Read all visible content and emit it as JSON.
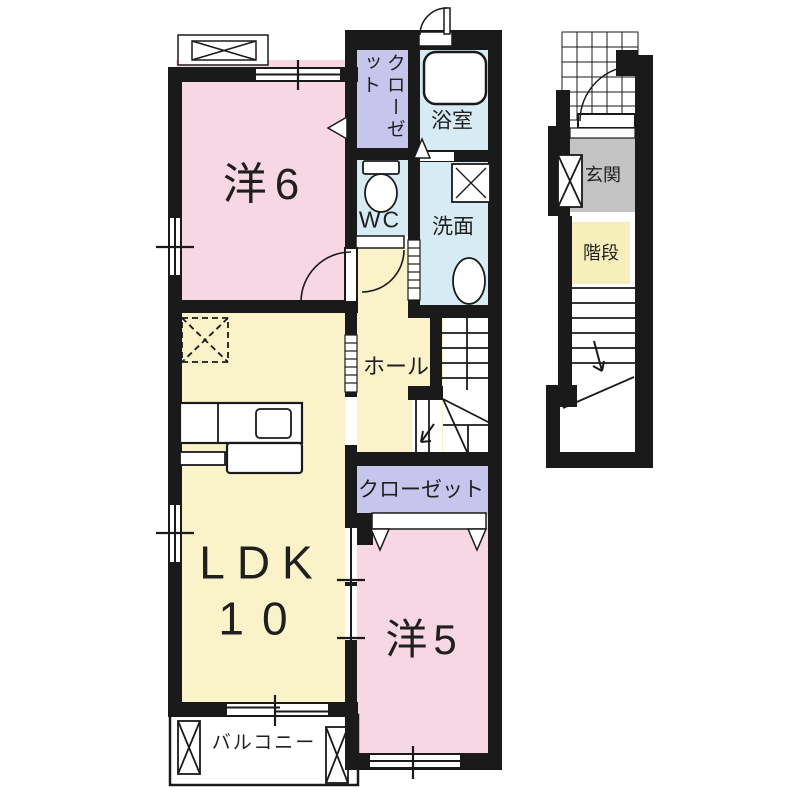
{
  "document_type": "apartment floor plan (2F unit with 1F entrance/stair section)",
  "colors": {
    "wall": "#1A1A1A",
    "room_pink": "#F8D7E4",
    "room_yellow": "#FAF3C9",
    "water_blue": "#D6EBF4",
    "closet_purple": "#C7C5EC",
    "entrance_gray": "#C3C3C3",
    "stairs_label_yellow": "#F6EFBC",
    "white": "#FFFFFF"
  },
  "rooms": {
    "western_room_6": {
      "label": "洋6"
    },
    "closet_upper": {
      "label": "クローゼット"
    },
    "bathroom": {
      "label": "浴室"
    },
    "toilet": {
      "label": "WC"
    },
    "washroom": {
      "label": "洗面"
    },
    "hall": {
      "label": "ホール"
    },
    "closet_lower": {
      "label": "クローゼット"
    },
    "ldk": {
      "label": "LDK",
      "size_label": "10"
    },
    "western_room_5": {
      "label": "洋5"
    },
    "balcony": {
      "label": "バルコニー"
    },
    "entrance": {
      "label": "玄関"
    },
    "staircase": {
      "label": "階段"
    }
  },
  "icons": {
    "bathtub": "rounded-rectangle",
    "toilet": "tank-and-bowl",
    "washbasin": "oval",
    "washer_pan": "square-with-x",
    "kitchen_counter": "rects-with-sink",
    "refrigerator_space": "dashed-square-with-x",
    "ac_unit_platform": "box-with-x",
    "door_swing": "quarter-arc",
    "folding_door": "v-chevrons",
    "sliding_door": "striped-strip",
    "window": "double-line-with-tick",
    "stairs": "treads-with-arrow",
    "porch_tiles": "grid-hatch"
  }
}
